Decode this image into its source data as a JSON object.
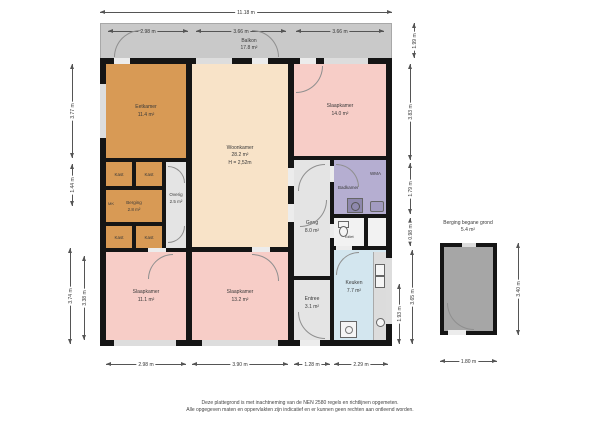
{
  "overall_width": "11.18 m",
  "balcony": {
    "name": "Balkon",
    "area": "17.8 m²",
    "dim_left": "2.98 m",
    "dim_mid": "3.66 m",
    "dim_right": "3.66 m",
    "dim_height": "1.99 m"
  },
  "rooms": {
    "eetkamer": {
      "name": "Eetkamer",
      "area": "11.4 m²"
    },
    "woonkamer": {
      "name": "Woonkamer",
      "area": "28.2 m²",
      "height": "H = 2,52m"
    },
    "slaapkamer_top": {
      "name": "Slaapkamer",
      "area": "14.0 m²"
    },
    "slaapkamer_left": {
      "name": "Slaapkamer",
      "area": "11.1 m²"
    },
    "slaapkamer_mid": {
      "name": "Slaapkamer",
      "area": "13.2 m²"
    },
    "badkamer": {
      "name": "Badkamer",
      "wma": "WMA"
    },
    "toilet": {
      "name": "Toilet"
    },
    "gang": {
      "name": "Gang",
      "area": "8.0 m²"
    },
    "entree": {
      "name": "Entree",
      "area": "3.1 m²"
    },
    "keuken": {
      "name": "Keuken",
      "area": "7.7 m²"
    },
    "berging": {
      "name": "Berging",
      "area": "2.8 m²"
    },
    "overig": {
      "name": "Overig",
      "area": "2.5 m²"
    },
    "kast": {
      "name": "Kast"
    },
    "mk": {
      "name": "MK"
    }
  },
  "dims": {
    "left": [
      "3.77 m",
      "1.44 m",
      "3.74 m",
      "3.38 m"
    ],
    "right": [
      "3.83 m",
      "1.79 m",
      "0.98 m",
      "3.65 m",
      "1.93 m"
    ],
    "bottom": [
      "2.98 m",
      "3.90 m",
      "1.28 m",
      "2.29 m"
    ]
  },
  "storage": {
    "title": "Berging begane grond",
    "area": "5.4 m²",
    "width": "1.80 m",
    "height": "3.40 m"
  },
  "footer": {
    "line1": "Deze plattegrond is met inachtneming van de NEN 2580 regels en richtlijnen opgemeten.",
    "line2": "Alle opgegeven maten en oppervlakten zijn indicatief en er kunnen geen rechten aan ontleend worden."
  },
  "colors": {
    "wall": "#151515",
    "balcony": "#c9c9c9",
    "storage_floor": "#a6a6a6",
    "room_orange": "#d89a55",
    "room_peach": "#f8e3c8",
    "room_pink": "#f7cdc7",
    "room_lavender": "#b5aed1",
    "room_gray": "#e4e4e4",
    "room_blue": "#d3e6ef"
  }
}
